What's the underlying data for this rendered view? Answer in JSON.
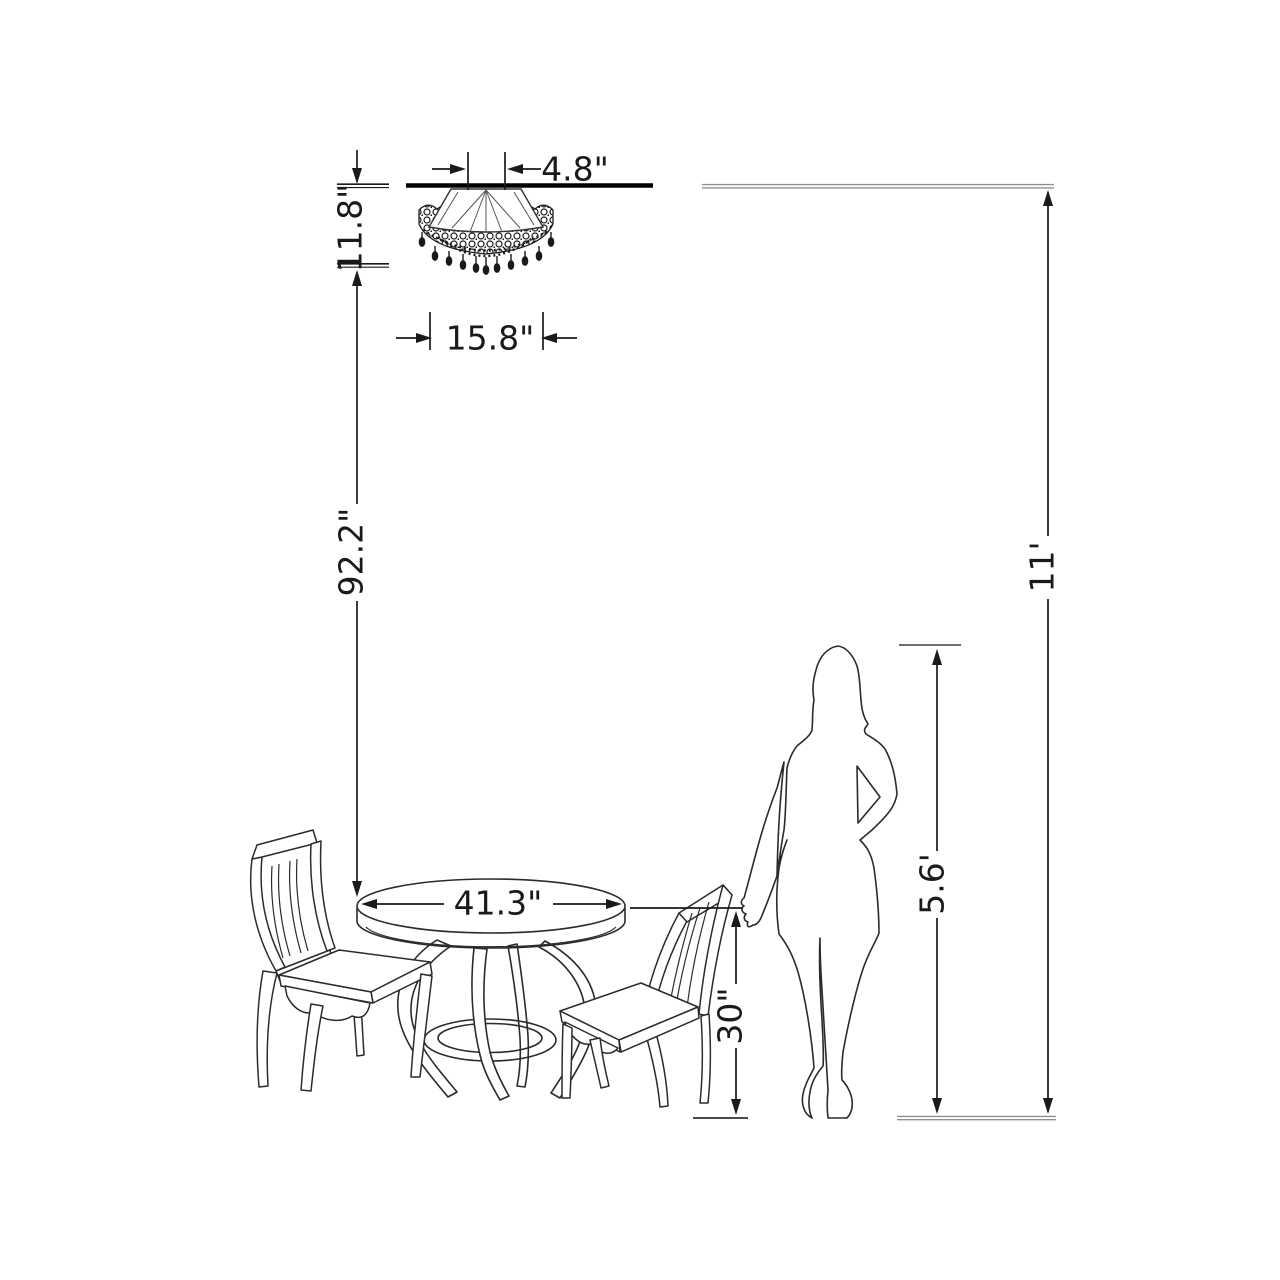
{
  "diagram": {
    "type": "product-dimension-diagram",
    "subject": "flush-mount crystal chandelier over round pedestal dining table, two chairs, woman silhouette for scale"
  },
  "dimensions": {
    "canopy_width": "4.8\"",
    "fixture_height": "11.8\"",
    "fixture_width": "15.8\"",
    "chandelier_to_table": "92.2\"",
    "table_diameter": "41.3\"",
    "table_height": "30\"",
    "person_height": "5.6'",
    "ceiling_height": "11'"
  },
  "colors": {
    "background": "#ffffff",
    "outline": "#2b2b2b",
    "dimension_line": "#1a1a1a",
    "reference_line": "#8f8f8f",
    "mount_bar": "#000000"
  }
}
